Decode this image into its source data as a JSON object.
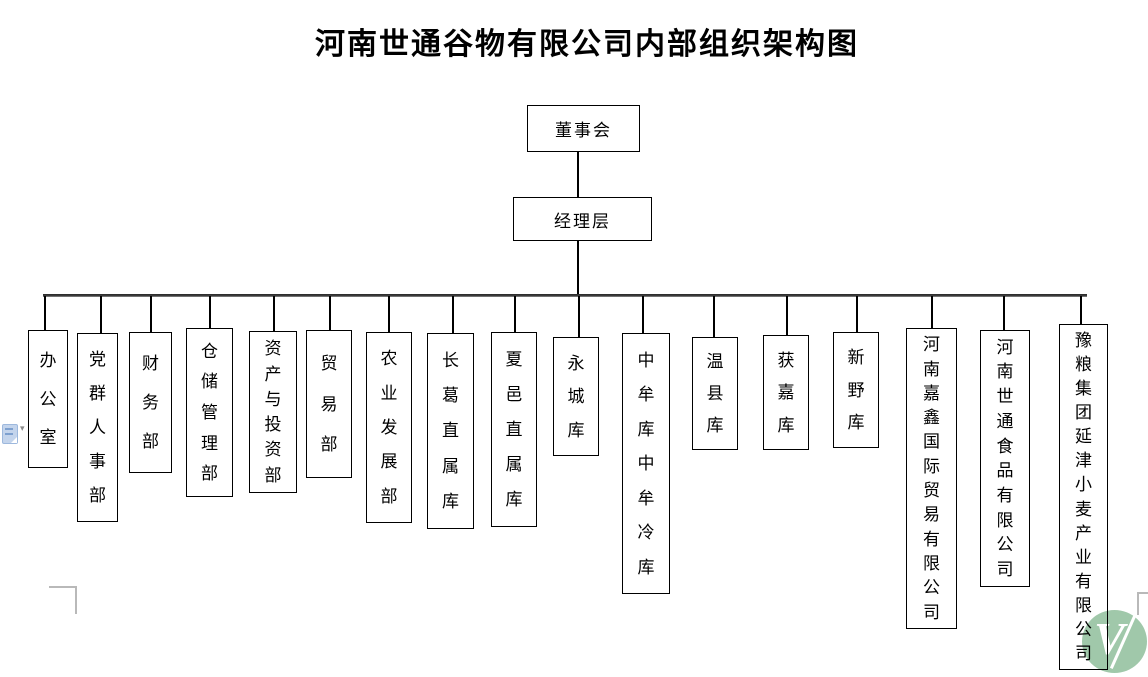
{
  "title": "河南世通谷物有限公司内部组织架构图",
  "org": {
    "root": {
      "label": "董事会"
    },
    "management": {
      "label": "经理层"
    },
    "departments": [
      {
        "label": "办公室"
      },
      {
        "label": "党群人事部"
      },
      {
        "label": "财务部"
      },
      {
        "label": "仓储管理部"
      },
      {
        "label": "资产与投资部"
      },
      {
        "label": "贸易部"
      },
      {
        "label": "农业发展部"
      },
      {
        "label": "长葛直属库"
      },
      {
        "label": "夏邑直属库"
      },
      {
        "label": "永城库"
      },
      {
        "label": "中牟库中牟冷库"
      },
      {
        "label": "温县库"
      },
      {
        "label": "获嘉库"
      },
      {
        "label": "新野库"
      },
      {
        "label": "河南嘉鑫国际贸易有限公司"
      },
      {
        "label": "河南世通食品有限公司"
      },
      {
        "label": "豫粮集团延津小麦产业有限公司"
      }
    ]
  },
  "watermark": {
    "letter": "V",
    "color": "#a0c8aa"
  },
  "icons": {
    "paste_options": "paste-options-document-icon",
    "dropdown_arrow": "▾"
  },
  "colors": {
    "box_border": "#000000",
    "connector_rail": "#2e2e2e",
    "watermark_green": "#a0c8aa",
    "icon_blue": "#c3d4ec",
    "boundary_mark_gray": "#b9b9b9"
  }
}
